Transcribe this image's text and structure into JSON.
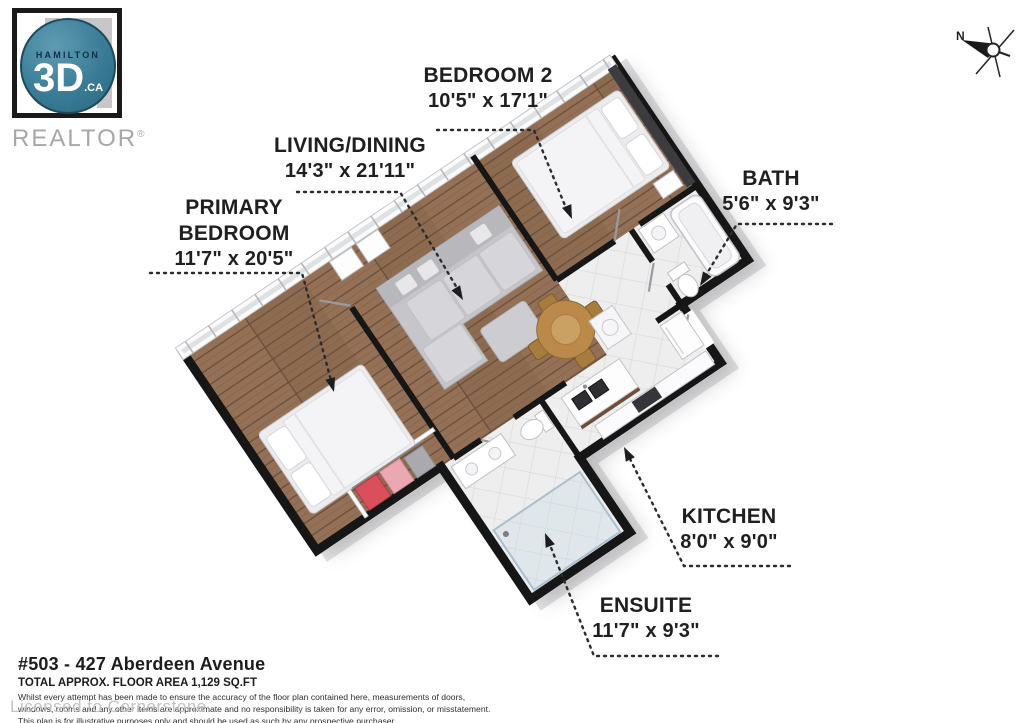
{
  "logo": {
    "brand_top": "HAMILTON",
    "brand_main": "3D",
    "brand_tld": ".CA",
    "realtor": "REALTOR",
    "registered": "®"
  },
  "compass": {
    "label": "N"
  },
  "rooms": [
    {
      "id": "bedroom-2",
      "name": "BEDROOM 2",
      "dims": "10'5\" x 17'1\""
    },
    {
      "id": "living-dining",
      "name": "LIVING/DINING",
      "dims": "14'3\" x 21'11\""
    },
    {
      "id": "primary-bedroom",
      "name": "PRIMARY BEDROOM",
      "dims": "11'7\" x 20'5\""
    },
    {
      "id": "bath",
      "name": "BATH",
      "dims": "5'6\" x 9'3\""
    },
    {
      "id": "kitchen",
      "name": "KITCHEN",
      "dims": "8'0\" x 9'0\""
    },
    {
      "id": "ensuite",
      "name": "ENSUITE",
      "dims": "11'7\" x 9'3\""
    }
  ],
  "footer": {
    "address": "#503 - 427 Aberdeen Avenue",
    "area": "TOTAL APPROX. FLOOR AREA 1,129 SQ.FT",
    "disclaimer_lines": [
      "Whilst every attempt has been made to ensure the accuracy of the floor plan contained here, measurements of doors,",
      "windows, rooms and any other items are approximate and no responsibility is taken for any error, omission, or misstatement.",
      "This plan is for illustrative purposes only and should be used as such by any prospective purchaser."
    ],
    "license": "Licensed to Cornerstone"
  },
  "colors": {
    "logo_teal": "#3a7c96",
    "wall_black": "#161616",
    "wood_floor": "#8d6b50",
    "tile_floor": "#eeeeef",
    "sofa_gray": "#c6c6ca",
    "accent_wall": "#3b3b40",
    "closet_red": "#d94f5c",
    "closet_pink": "#eba7b2"
  }
}
